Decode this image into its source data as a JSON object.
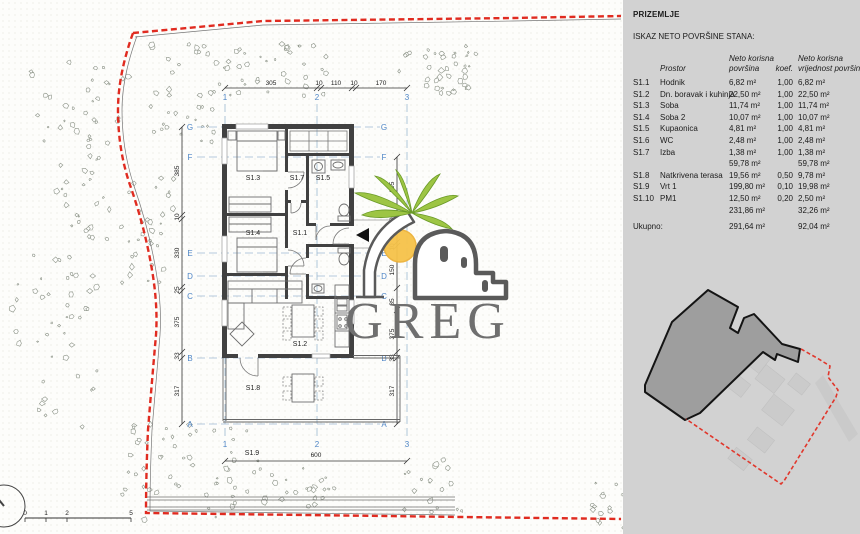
{
  "panel": {
    "floor_title": "PRIZEMLJE",
    "subtitle": "ISKAZ NETO POVRŠINE STANA:",
    "table": {
      "header": {
        "prostor": "Prostor",
        "area1": "Neto korisna",
        "area2": "površina",
        "koef": "koef.",
        "val1": "Neto korisna",
        "val2": "vrijednost površina"
      },
      "rows": [
        {
          "code": "S1.1",
          "name": "Hodnik",
          "area": "6,82 m²",
          "koef": "1,00",
          "value": "6,82 m²"
        },
        {
          "code": "S1.2",
          "name": "Dn. boravak i kuhinja",
          "area": "22,50 m²",
          "koef": "1,00",
          "value": "22,50 m²"
        },
        {
          "code": "S1.3",
          "name": "Soba",
          "area": "11,74 m²",
          "koef": "1,00",
          "value": "11,74 m²"
        },
        {
          "code": "S1.4",
          "name": "Soba 2",
          "area": "10,07 m²",
          "koef": "1,00",
          "value": "10,07 m²"
        },
        {
          "code": "S1.5",
          "name": "Kupaonica",
          "area": "4,81 m²",
          "koef": "1,00",
          "value": "4,81 m²"
        },
        {
          "code": "S1.6",
          "name": "WC",
          "area": "2,48 m²",
          "koef": "1,00",
          "value": "2,48 m²"
        },
        {
          "code": "S1.7",
          "name": "Izba",
          "area": "1,38 m²",
          "koef": "1,00",
          "value": "1,38 m²"
        },
        {
          "code": "",
          "name": "",
          "area": "59,78 m²",
          "koef": "",
          "value": "59,78 m²"
        },
        {
          "code": "S1.8",
          "name": "Natkrivena terasa",
          "area": "19,56 m²",
          "koef": "0,50",
          "value": "9,78 m²"
        },
        {
          "code": "S1.9",
          "name": "Vrt 1",
          "area": "199,80 m²",
          "koef": "0,10",
          "value": "19,98 m²"
        },
        {
          "code": "S1.10",
          "name": "PM1",
          "area": "12,50 m²",
          "koef": "0,20",
          "value": "2,50 m²"
        },
        {
          "code": "",
          "name": "",
          "area": "231,86 m²",
          "koef": "",
          "value": "32,26 m²"
        },
        {
          "code": "Ukupno:",
          "name": "",
          "area": "291,64 m²",
          "koef": "",
          "value": "92,04 m²"
        }
      ]
    }
  },
  "plan": {
    "room_labels": {
      "s1_1": "S1.1",
      "s1_2": "S1.2",
      "s1_3": "S1.3",
      "s1_4": "S1.4",
      "s1_5": "S1.5",
      "s1_7": "S1.7",
      "s1_8": "S1.8",
      "s1_9": "S1.9"
    },
    "grid_cols": [
      "1",
      "2",
      "3"
    ],
    "grid_rows": [
      "G",
      "F",
      "E",
      "D",
      "C",
      "B",
      "A"
    ],
    "dims": {
      "top": [
        "305",
        "10",
        "110",
        "10",
        "170"
      ],
      "bottom": "600",
      "left": [
        "385",
        "10",
        "330",
        "25",
        "375",
        "33",
        "317"
      ],
      "right": [
        "295",
        "10",
        "110",
        "10",
        "150",
        "85",
        "375",
        "33",
        "317"
      ]
    },
    "scalebar": [
      "0",
      "1",
      "2",
      "5"
    ]
  },
  "logo": {
    "text": "GREG"
  },
  "colors": {
    "boundary_red": "#e02b20",
    "grid_blue": "#4f86c6",
    "wall_gray": "#414141",
    "logo_green": "#9dc544",
    "logo_sun": "#f6c34a",
    "logo_gray": "#6f6f6f",
    "panel_bg": "#d2d2d2"
  }
}
